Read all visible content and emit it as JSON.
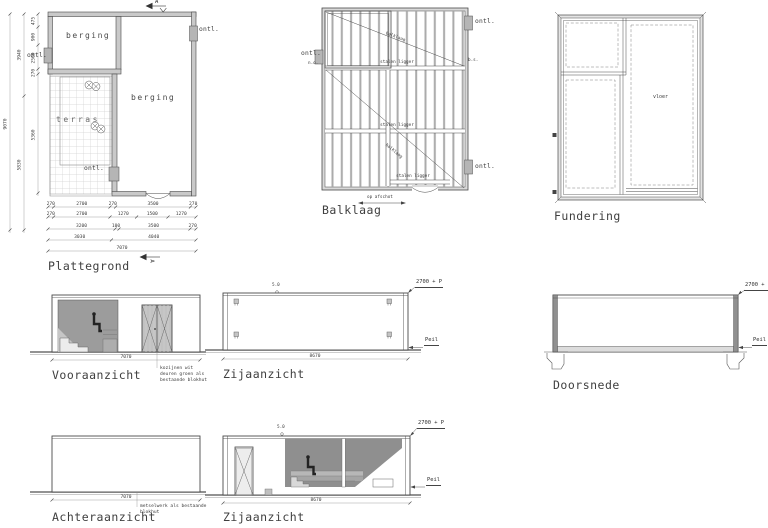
{
  "views": {
    "plattegrond": {
      "label": "Plattegrond",
      "rooms": {
        "berging_top": "berging",
        "berging_right": "berging",
        "terras": "terras"
      },
      "ontl_left": "ontl.",
      "ontl_bottom": "ontl.",
      "ontl_right": "ontl.",
      "section_letter": "A",
      "dims": {
        "row1": [
          "270",
          "2700",
          "270",
          "3500",
          "270"
        ],
        "row2": [
          "270",
          "2700",
          "1270",
          "1500",
          "1270"
        ],
        "row3": [
          "3200",
          "100",
          "3500",
          "270"
        ],
        "row4": [
          "3030",
          "4040"
        ],
        "row5": [
          "7070"
        ],
        "left_inner": [
          "475",
          "900",
          "2560",
          "270",
          "5360"
        ],
        "left_mid": [
          "3940",
          "5830"
        ],
        "left_outer": [
          "9070"
        ]
      }
    },
    "balklaag": {
      "label": "Balklaag",
      "beam_label": "stalen ligger",
      "joist_label": "balklaag",
      "ontl": "ontl.",
      "note_left": "n.o.",
      "note_right": "b.s.",
      "slope_note": "op afschot"
    },
    "fundering": {
      "label": "Fundering",
      "floor_label": "vloer"
    },
    "vooraanzicht": {
      "label": "Vooraanzicht",
      "width_dim": "7070",
      "note": [
        "kozijnen wit",
        "deuren groen als",
        "bestaande blokhut"
      ]
    },
    "zijaanzicht1": {
      "label": "Zijaanzicht",
      "width_dim": "8670",
      "height_mark": "2700 + P",
      "level_mark": "Peil",
      "top_note": "5.0"
    },
    "doorsnede": {
      "label": "Doorsnede",
      "height_mark": "2700 + P",
      "level_mark": "Peil"
    },
    "achteraanzicht": {
      "label": "Achteraanzicht",
      "width_dim": "7070",
      "note": [
        "metselwerk als bestaande",
        "blokhut"
      ]
    },
    "zijaanzicht2": {
      "label": "Zijaanzicht",
      "width_dim": "8670",
      "height_mark": "2700 + P",
      "level_mark": "Peil",
      "top_note": "5.0"
    }
  },
  "colors": {
    "line": "#4a4a4a",
    "wall_fill": "#c9c9c9",
    "shade_dark": "#8f8f8f",
    "shade_mid": "#b5b5b5",
    "ground": "#6f6f6f"
  }
}
